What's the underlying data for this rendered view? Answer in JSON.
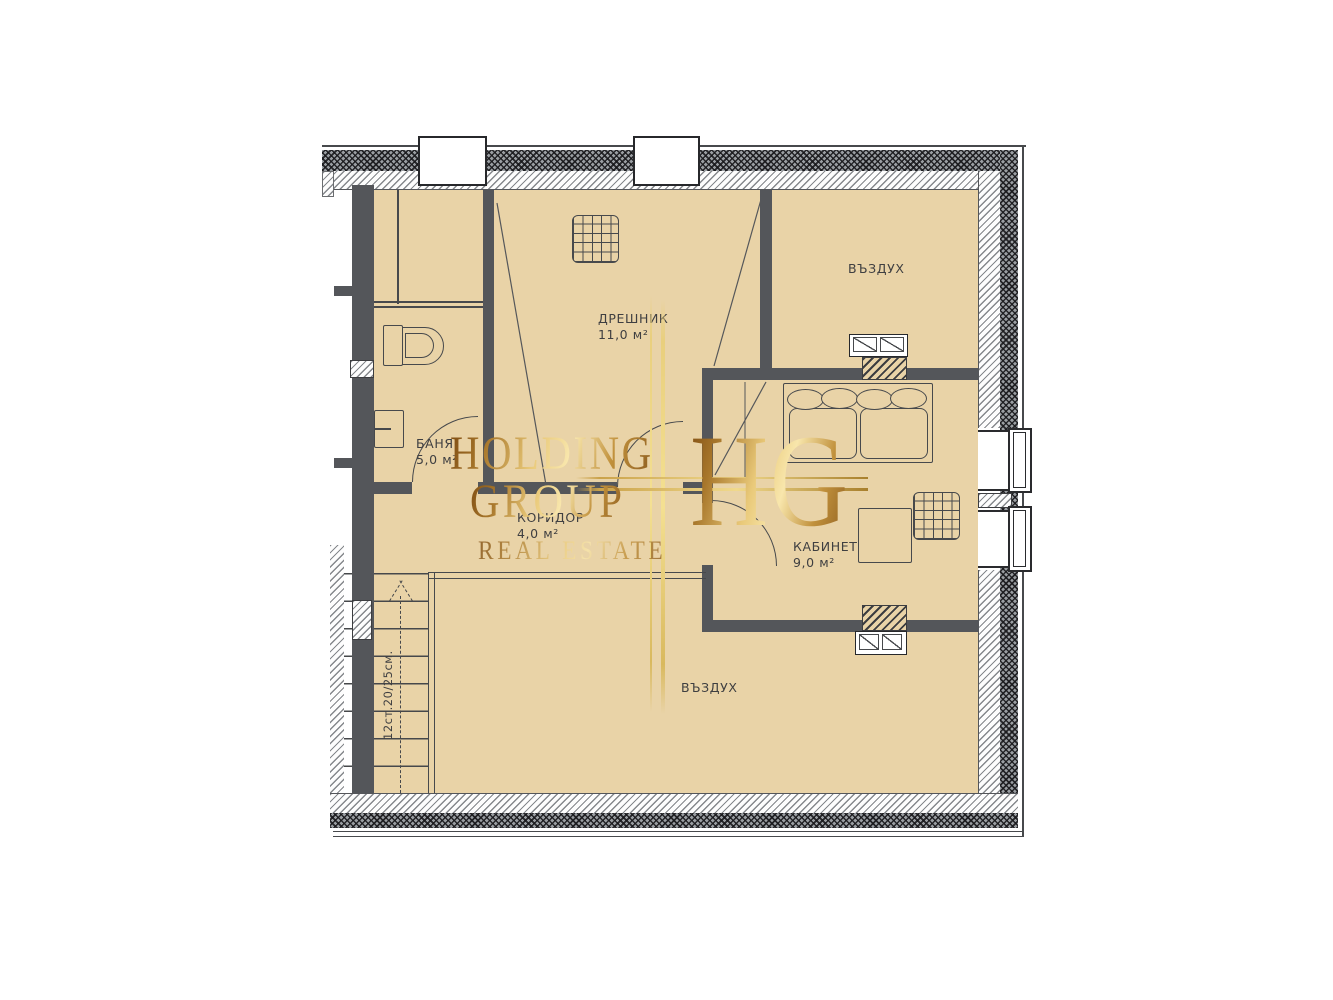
{
  "rooms": {
    "dreshnik": {
      "name": "ДРЕШНИК",
      "area": "11,0 м²"
    },
    "vazduh_top": {
      "name": "ВЪЗДУХ"
    },
    "banya": {
      "name": "БАНЯ",
      "area": "5,0 м²"
    },
    "koridor": {
      "name": "КОРИДОР",
      "area": "4,0 м²"
    },
    "kabinet": {
      "name": "КАБИНЕТ",
      "area": "9,0 м²"
    },
    "vazduh_bottom": {
      "name": "ВЪЗДУХ"
    }
  },
  "stairs": {
    "label": "12ст.20/25см."
  },
  "watermark": {
    "line1": "HOLDING",
    "line2": "GROUP",
    "line3": "REAL ESTATE",
    "monogram": "HG",
    "gold_dark": "#8a5a1e",
    "gold_light": "#f8e6ac"
  },
  "colors": {
    "floor": "#e9d3a7",
    "wall": "#54565a",
    "line": "#47494c"
  }
}
